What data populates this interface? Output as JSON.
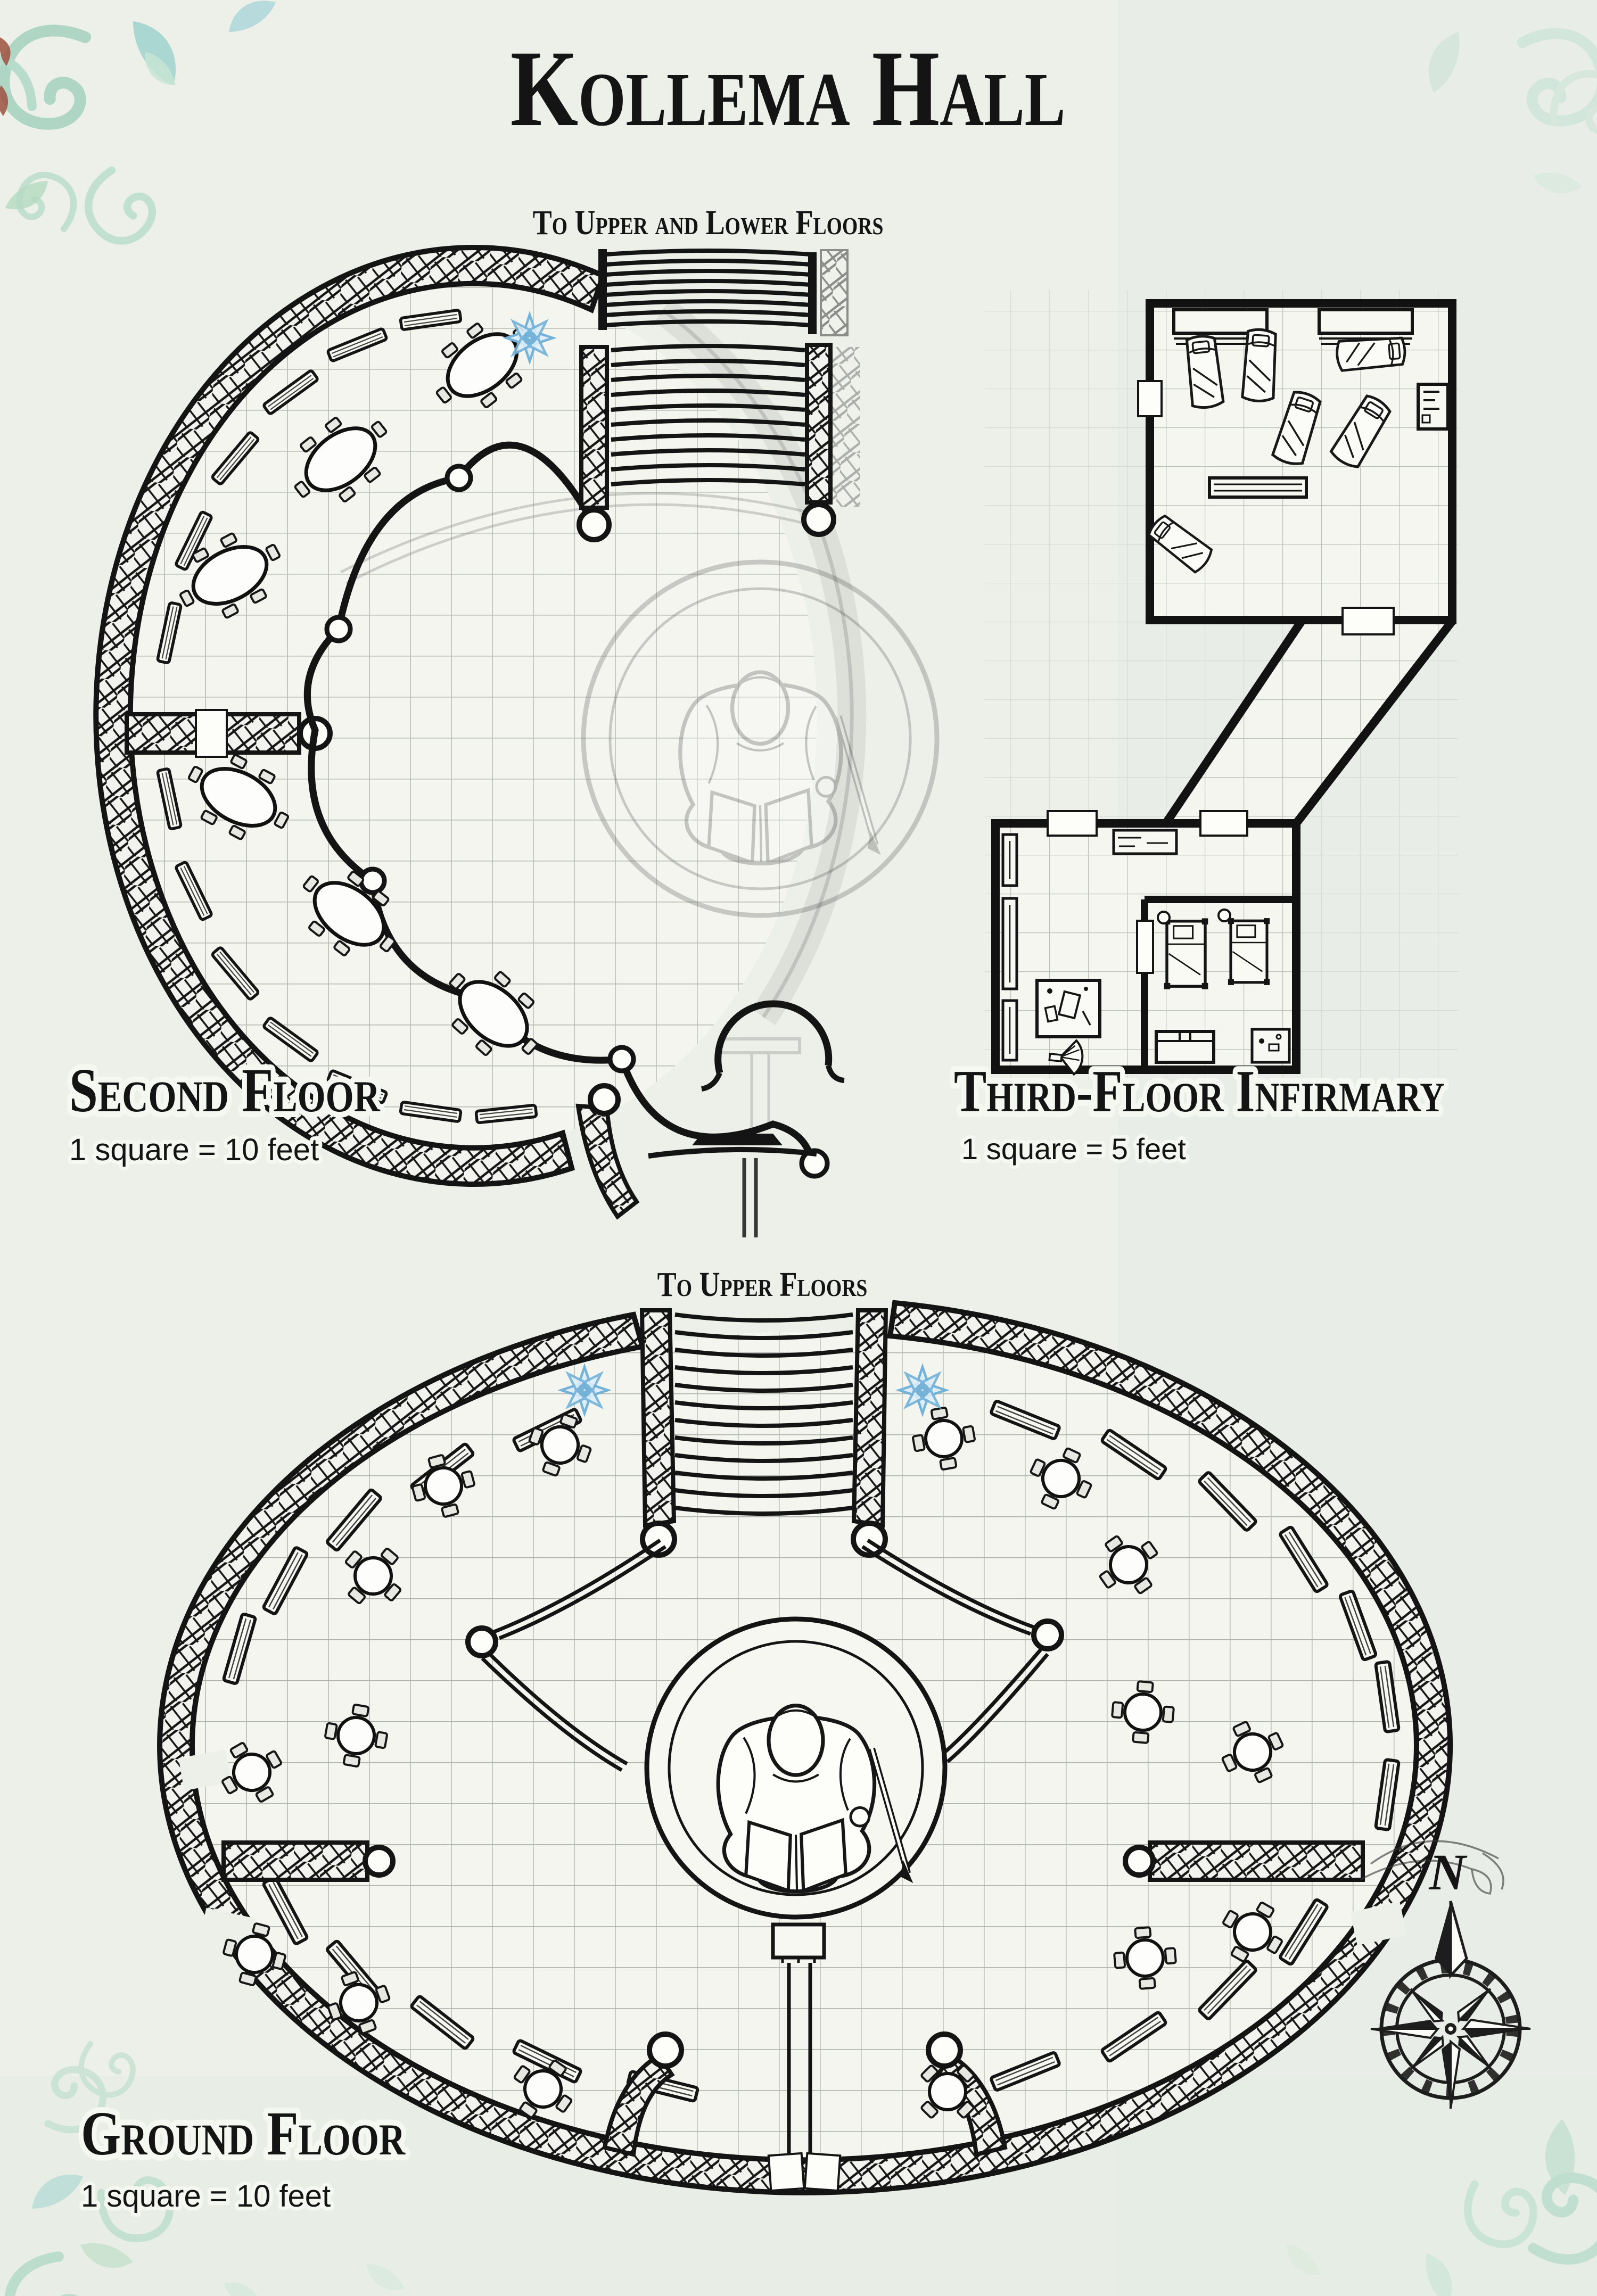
{
  "page_title": "Kollema Hall",
  "sections": {
    "second_floor": {
      "title": "Second Floor",
      "scale_note": "1 square = 10 feet",
      "stairs_label": "To Upper and Lower Floors"
    },
    "third_floor_infirmary": {
      "title": "Third-Floor Infirmary",
      "scale_note": "1 square = 5 feet"
    },
    "ground_floor": {
      "title": "Ground Floor",
      "scale_note": "1 square = 10 feet",
      "stairs_label": "To Upper Floors"
    }
  },
  "compass": {
    "north_label": "N"
  },
  "icons": {
    "rune_icon": "blue-eight-pointed-star",
    "statue": "robed-figure-reading-book",
    "compass": "hand-drawn-compass-rose"
  },
  "palette": {
    "paper": "#edf0e9",
    "ink": "#141414",
    "grid": "#aeb4aa",
    "rune_blue": "#74b2d8",
    "flourish_teal": "#9fd0bb",
    "flourish_aqua": "#8ccbc7",
    "accent_red": "#8a2a14"
  }
}
